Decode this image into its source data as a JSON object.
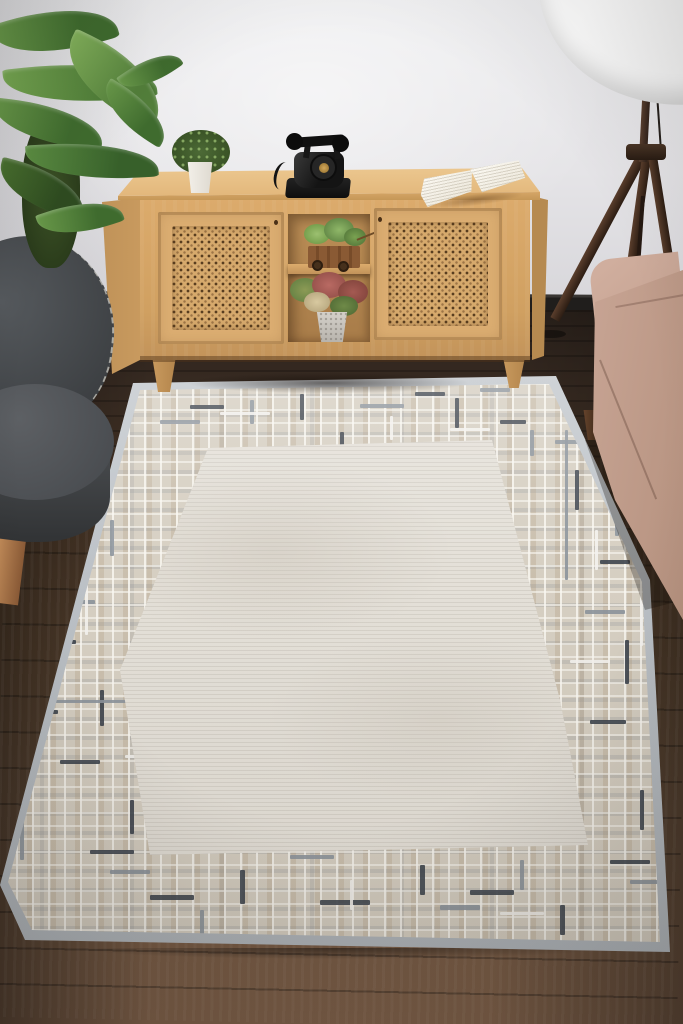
{
  "meta": {
    "description": "Product photograph of a living room: ivory rug with geometric maze border on dark wood floor, oak sideboard with cane doors, vintage black telephone, open book, potted plants, gray armchair, tripod floor lamp and beige sofa",
    "visible_text": "none"
  },
  "palette": {
    "wall": "#e9e8eb",
    "baseboard": "#201e1c",
    "floor_dark": "#2a211b",
    "floor_light": "#7a5d47",
    "cabinet_wood": "#d8a96b",
    "cane_webbing": "#d6a96c",
    "rug_field": "#e4e0d8",
    "rug_border_base": "#d6cfc2",
    "rug_binding": "#b4bac0",
    "rug_accent_dark": "#3b414b",
    "rug_accent_slate": "#8b929b",
    "chair_fabric": "#4b4e52",
    "sofa_fabric": "#c2a090",
    "lamp_shade": "#f7f7f7",
    "lamp_wood": "#4a3327",
    "plant_green": "#4e7c3a",
    "phone_black": "#141414",
    "phone_dial_brass": "#b58e3f"
  },
  "objects": [
    {
      "name": "area-rug",
      "label": "ivory rug with geometric border"
    },
    {
      "name": "sideboard",
      "label": "oak sideboard with cane doors"
    },
    {
      "name": "rotary-telephone",
      "label": "black vintage telephone"
    },
    {
      "name": "open-book",
      "label": "open book"
    },
    {
      "name": "potted-plant-small",
      "label": "small potted plant"
    },
    {
      "name": "succulent-cart",
      "label": "succulent in wooden cart"
    },
    {
      "name": "shelf-plant",
      "label": "colorful plant in stone pot"
    },
    {
      "name": "armchair",
      "label": "dark gray armchair"
    },
    {
      "name": "houseplant",
      "label": "large green houseplant"
    },
    {
      "name": "tripod-floor-lamp",
      "label": "tripod floor lamp with white shade"
    },
    {
      "name": "sofa",
      "label": "beige sofa"
    }
  ],
  "rug": {
    "dash_colors": {
      "dark": "#3b414b",
      "slate": "#8b929b",
      "white": "#f4f2ee",
      "beige": "#c9b89b"
    },
    "dashes": [
      {
        "x": 190,
        "y": 35,
        "w": 34,
        "h": 4,
        "c": "dark"
      },
      {
        "x": 300,
        "y": 24,
        "w": 4,
        "h": 26,
        "c": "dark"
      },
      {
        "x": 415,
        "y": 22,
        "w": 30,
        "h": 4,
        "c": "dark"
      },
      {
        "x": 455,
        "y": 28,
        "w": 4,
        "h": 30,
        "c": "dark"
      },
      {
        "x": 500,
        "y": 50,
        "w": 26,
        "h": 4,
        "c": "dark"
      },
      {
        "x": 340,
        "y": 62,
        "w": 4,
        "h": 20,
        "c": "dark"
      },
      {
        "x": 160,
        "y": 50,
        "w": 40,
        "h": 4,
        "c": "slate"
      },
      {
        "x": 250,
        "y": 30,
        "w": 4,
        "h": 24,
        "c": "slate"
      },
      {
        "x": 360,
        "y": 34,
        "w": 44,
        "h": 4,
        "c": "slate"
      },
      {
        "x": 480,
        "y": 18,
        "w": 30,
        "h": 4,
        "c": "slate"
      },
      {
        "x": 530,
        "y": 60,
        "w": 4,
        "h": 26,
        "c": "slate"
      },
      {
        "x": 220,
        "y": 42,
        "w": 50,
        "h": 3,
        "c": "white"
      },
      {
        "x": 390,
        "y": 46,
        "w": 3,
        "h": 24,
        "c": "white"
      },
      {
        "x": 450,
        "y": 58,
        "w": 40,
        "h": 3,
        "c": "white"
      },
      {
        "x": 70,
        "y": 190,
        "w": 4,
        "h": 40,
        "c": "dark"
      },
      {
        "x": 40,
        "y": 270,
        "w": 36,
        "h": 4,
        "c": "dark"
      },
      {
        "x": 100,
        "y": 320,
        "w": 4,
        "h": 36,
        "c": "dark"
      },
      {
        "x": 60,
        "y": 390,
        "w": 40,
        "h": 4,
        "c": "dark"
      },
      {
        "x": 130,
        "y": 430,
        "w": 4,
        "h": 34,
        "c": "dark"
      },
      {
        "x": 90,
        "y": 480,
        "w": 44,
        "h": 4,
        "c": "dark"
      },
      {
        "x": 30,
        "y": 340,
        "w": 28,
        "h": 4,
        "c": "dark"
      },
      {
        "x": 110,
        "y": 150,
        "w": 4,
        "h": 36,
        "c": "slate"
      },
      {
        "x": 55,
        "y": 230,
        "w": 40,
        "h": 4,
        "c": "slate"
      },
      {
        "x": 140,
        "y": 360,
        "w": 36,
        "h": 4,
        "c": "slate"
      },
      {
        "x": 20,
        "y": 450,
        "w": 4,
        "h": 40,
        "c": "slate"
      },
      {
        "x": 160,
        "y": 270,
        "w": 4,
        "h": 30,
        "c": "slate"
      },
      {
        "x": 85,
        "y": 215,
        "w": 3,
        "h": 50,
        "c": "white"
      },
      {
        "x": 125,
        "y": 385,
        "w": 46,
        "h": 3,
        "c": "white"
      },
      {
        "x": 45,
        "y": 320,
        "w": 3,
        "h": 44,
        "c": "white"
      },
      {
        "x": 575,
        "y": 100,
        "w": 4,
        "h": 40,
        "c": "dark"
      },
      {
        "x": 600,
        "y": 190,
        "w": 30,
        "h": 4,
        "c": "dark"
      },
      {
        "x": 625,
        "y": 270,
        "w": 4,
        "h": 44,
        "c": "dark"
      },
      {
        "x": 590,
        "y": 350,
        "w": 36,
        "h": 4,
        "c": "dark"
      },
      {
        "x": 640,
        "y": 420,
        "w": 4,
        "h": 40,
        "c": "dark"
      },
      {
        "x": 610,
        "y": 490,
        "w": 40,
        "h": 4,
        "c": "dark"
      },
      {
        "x": 555,
        "y": 70,
        "w": 30,
        "h": 4,
        "c": "slate"
      },
      {
        "x": 615,
        "y": 130,
        "w": 4,
        "h": 36,
        "c": "slate"
      },
      {
        "x": 585,
        "y": 240,
        "w": 40,
        "h": 4,
        "c": "slate"
      },
      {
        "x": 650,
        "y": 330,
        "w": 4,
        "h": 36,
        "c": "slate"
      },
      {
        "x": 630,
        "y": 510,
        "w": 36,
        "h": 4,
        "c": "slate"
      },
      {
        "x": 595,
        "y": 160,
        "w": 3,
        "h": 40,
        "c": "white"
      },
      {
        "x": 640,
        "y": 230,
        "w": 3,
        "h": 46,
        "c": "white"
      },
      {
        "x": 570,
        "y": 290,
        "w": 40,
        "h": 3,
        "c": "white"
      },
      {
        "x": 150,
        "y": 525,
        "w": 44,
        "h": 5,
        "c": "dark"
      },
      {
        "x": 240,
        "y": 500,
        "w": 5,
        "h": 34,
        "c": "dark"
      },
      {
        "x": 320,
        "y": 530,
        "w": 50,
        "h": 5,
        "c": "dark"
      },
      {
        "x": 420,
        "y": 495,
        "w": 5,
        "h": 30,
        "c": "dark"
      },
      {
        "x": 470,
        "y": 520,
        "w": 44,
        "h": 5,
        "c": "dark"
      },
      {
        "x": 560,
        "y": 535,
        "w": 5,
        "h": 30,
        "c": "dark"
      },
      {
        "x": 380,
        "y": 470,
        "w": 40,
        "h": 4,
        "c": "dark"
      },
      {
        "x": 110,
        "y": 500,
        "w": 40,
        "h": 4,
        "c": "slate"
      },
      {
        "x": 200,
        "y": 540,
        "w": 4,
        "h": 26,
        "c": "slate"
      },
      {
        "x": 290,
        "y": 485,
        "w": 44,
        "h": 4,
        "c": "slate"
      },
      {
        "x": 440,
        "y": 535,
        "w": 40,
        "h": 5,
        "c": "slate"
      },
      {
        "x": 520,
        "y": 490,
        "w": 4,
        "h": 30,
        "c": "slate"
      },
      {
        "x": 170,
        "y": 480,
        "w": 50,
        "h": 3,
        "c": "white"
      },
      {
        "x": 350,
        "y": 510,
        "w": 3,
        "h": 30,
        "c": "white"
      },
      {
        "x": 500,
        "y": 542,
        "w": 44,
        "h": 3,
        "c": "white"
      },
      {
        "x": 250,
        "y": 190,
        "w": 3,
        "h": 240,
        "c": "beige"
      },
      {
        "x": 330,
        "y": 460,
        "w": 200,
        "h": 3,
        "c": "beige"
      },
      {
        "x": 20,
        "y": 330,
        "w": 180,
        "h": 3,
        "c": "slate"
      },
      {
        "x": 565,
        "y": 60,
        "w": 3,
        "h": 150,
        "c": "slate"
      },
      {
        "x": 460,
        "y": 90,
        "w": 3,
        "h": 120,
        "c": "white"
      }
    ]
  }
}
